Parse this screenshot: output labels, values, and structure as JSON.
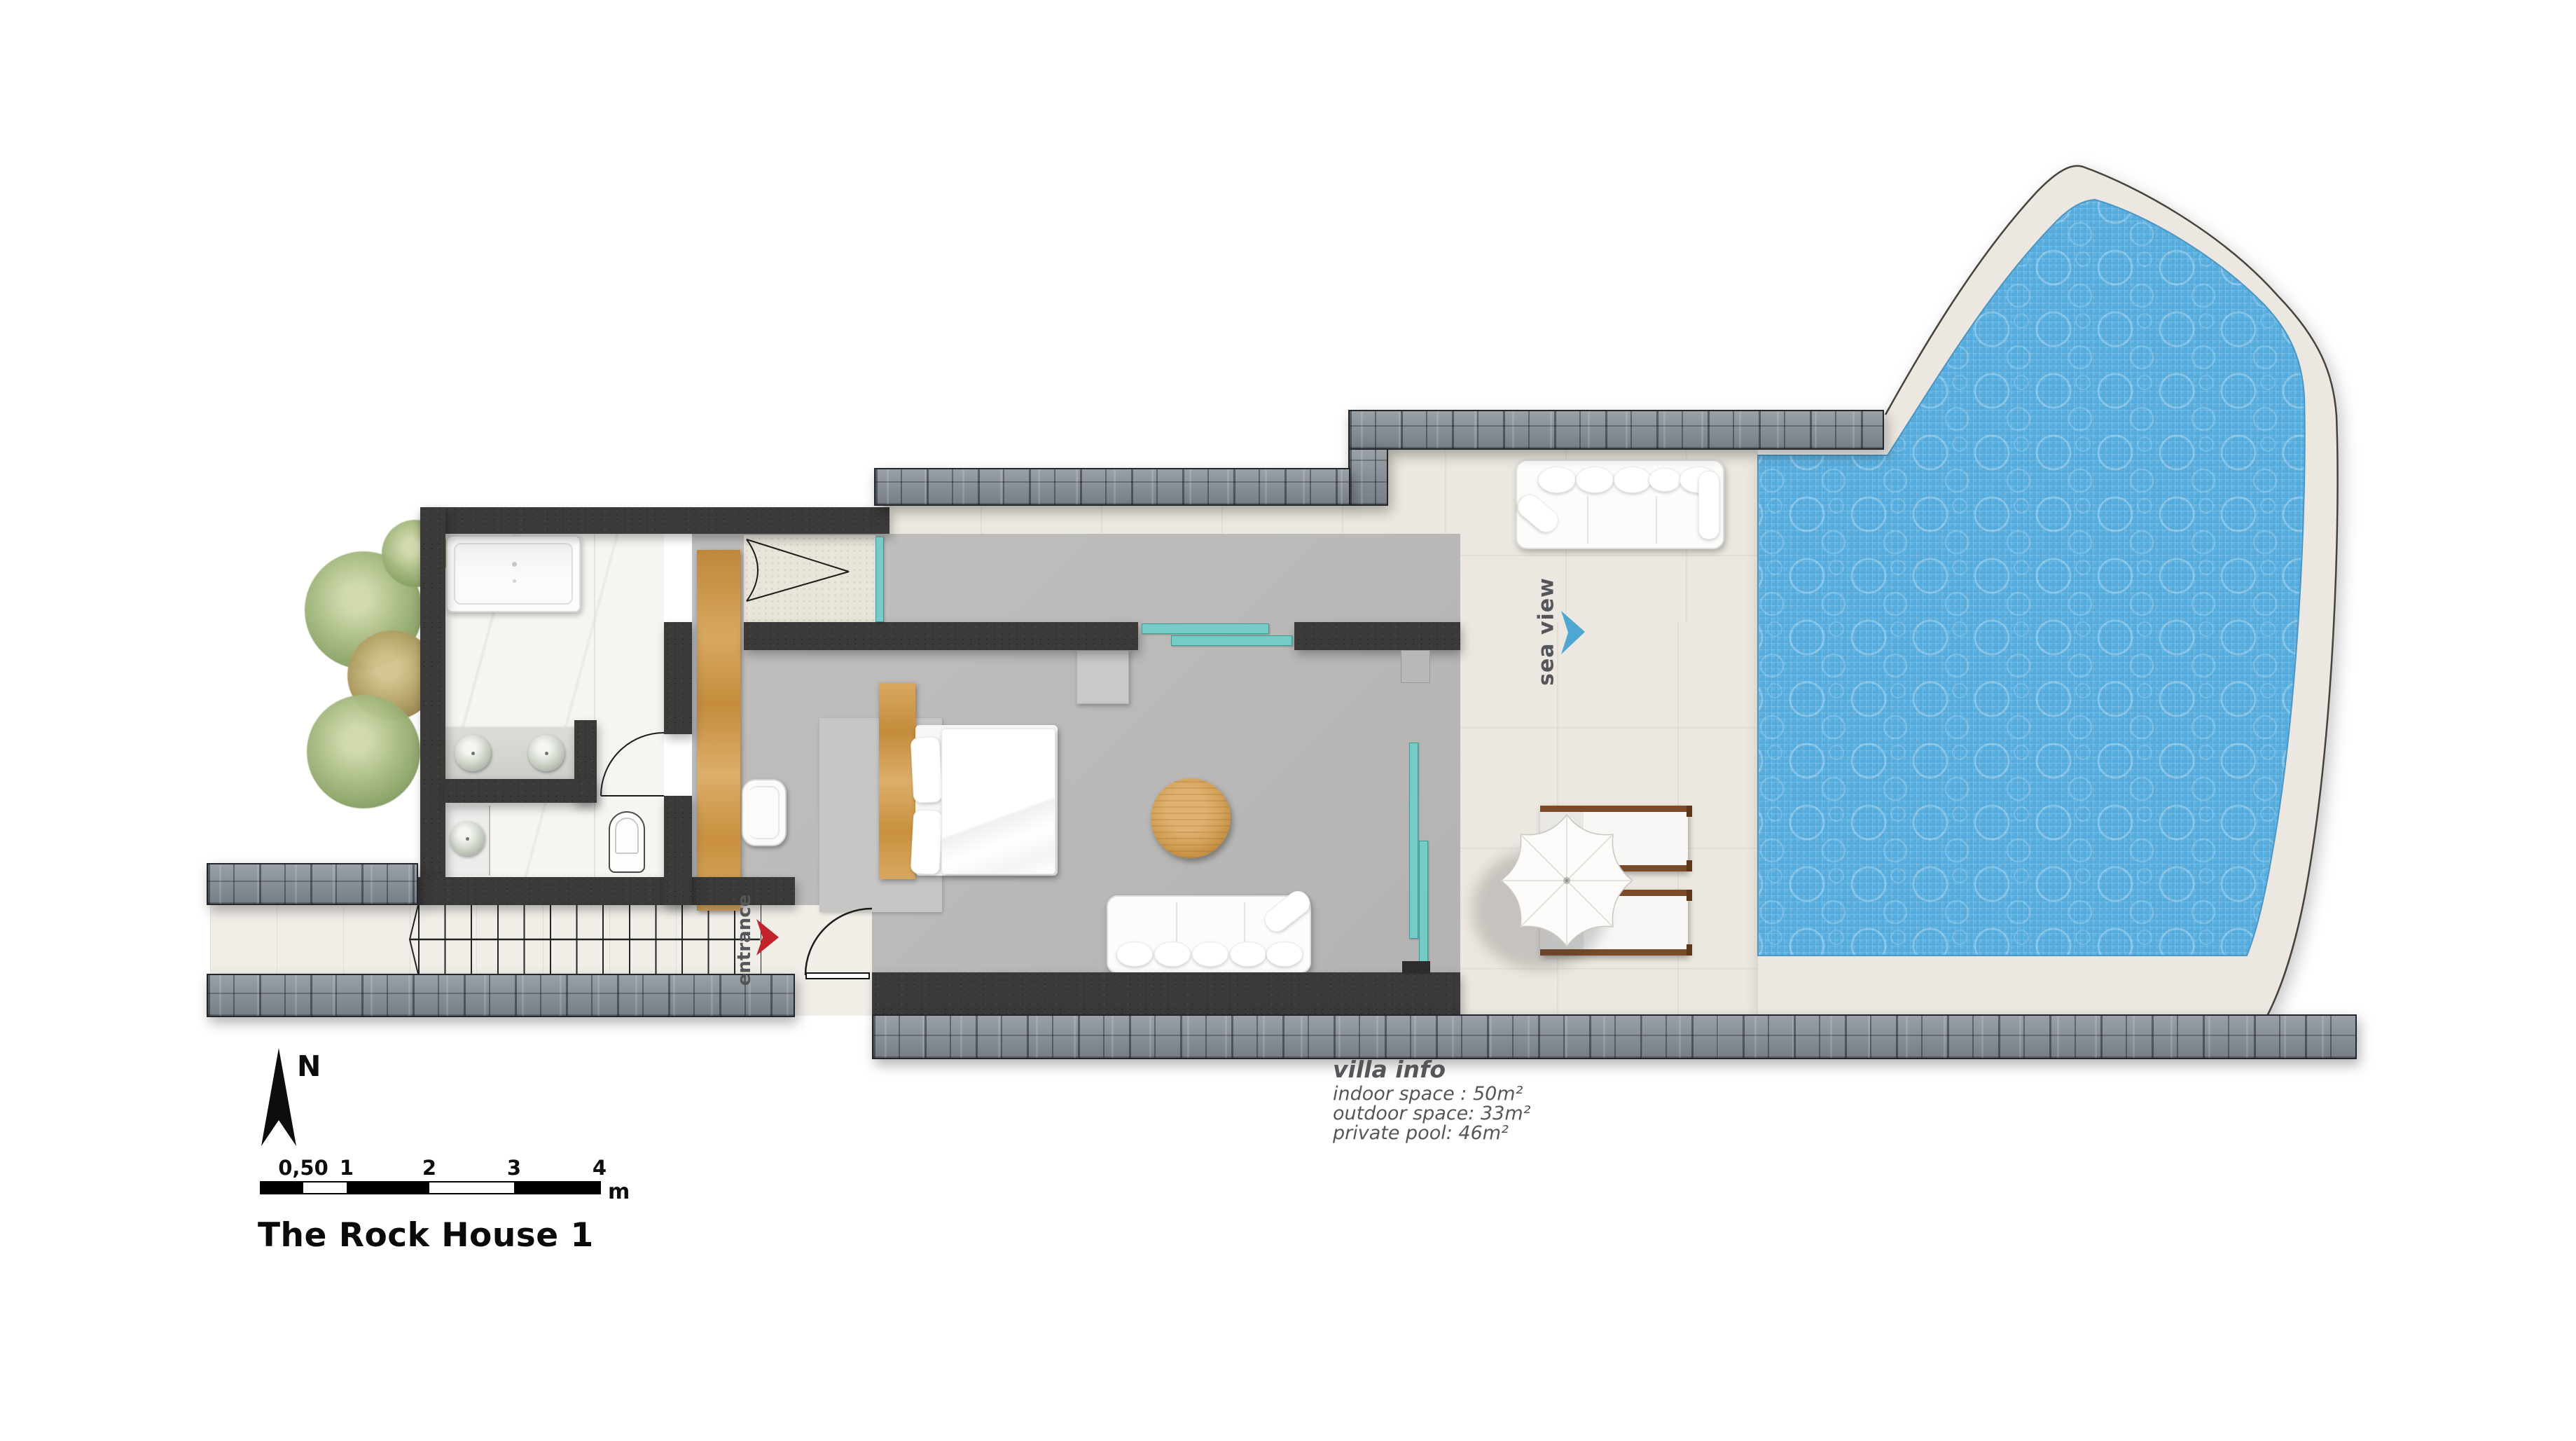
{
  "title": "The Rock House 1",
  "compass": {
    "label": "N"
  },
  "scale_bar": {
    "ticks": [
      "0,50",
      "1",
      "2",
      "3",
      "4"
    ],
    "unit": "m"
  },
  "annotations": {
    "sea_view": "sea view",
    "entrance": "entrance"
  },
  "villa_info": {
    "heading": "villa info",
    "lines": [
      "indoor space : 50m²",
      "outdoor space: 33m²",
      "private pool: 46m²"
    ]
  },
  "colors": {
    "pool_water": "#55abdc",
    "pool_deck": "#ece7e0",
    "window_teal": "#76cbc7",
    "entrance_arrow_red": "#c3222b",
    "sea_view_arrow_blue": "#4da7d2",
    "annotation_gray": "#55565a",
    "wall_dark": "#3b3a39",
    "stone_gray": "#868c93"
  }
}
